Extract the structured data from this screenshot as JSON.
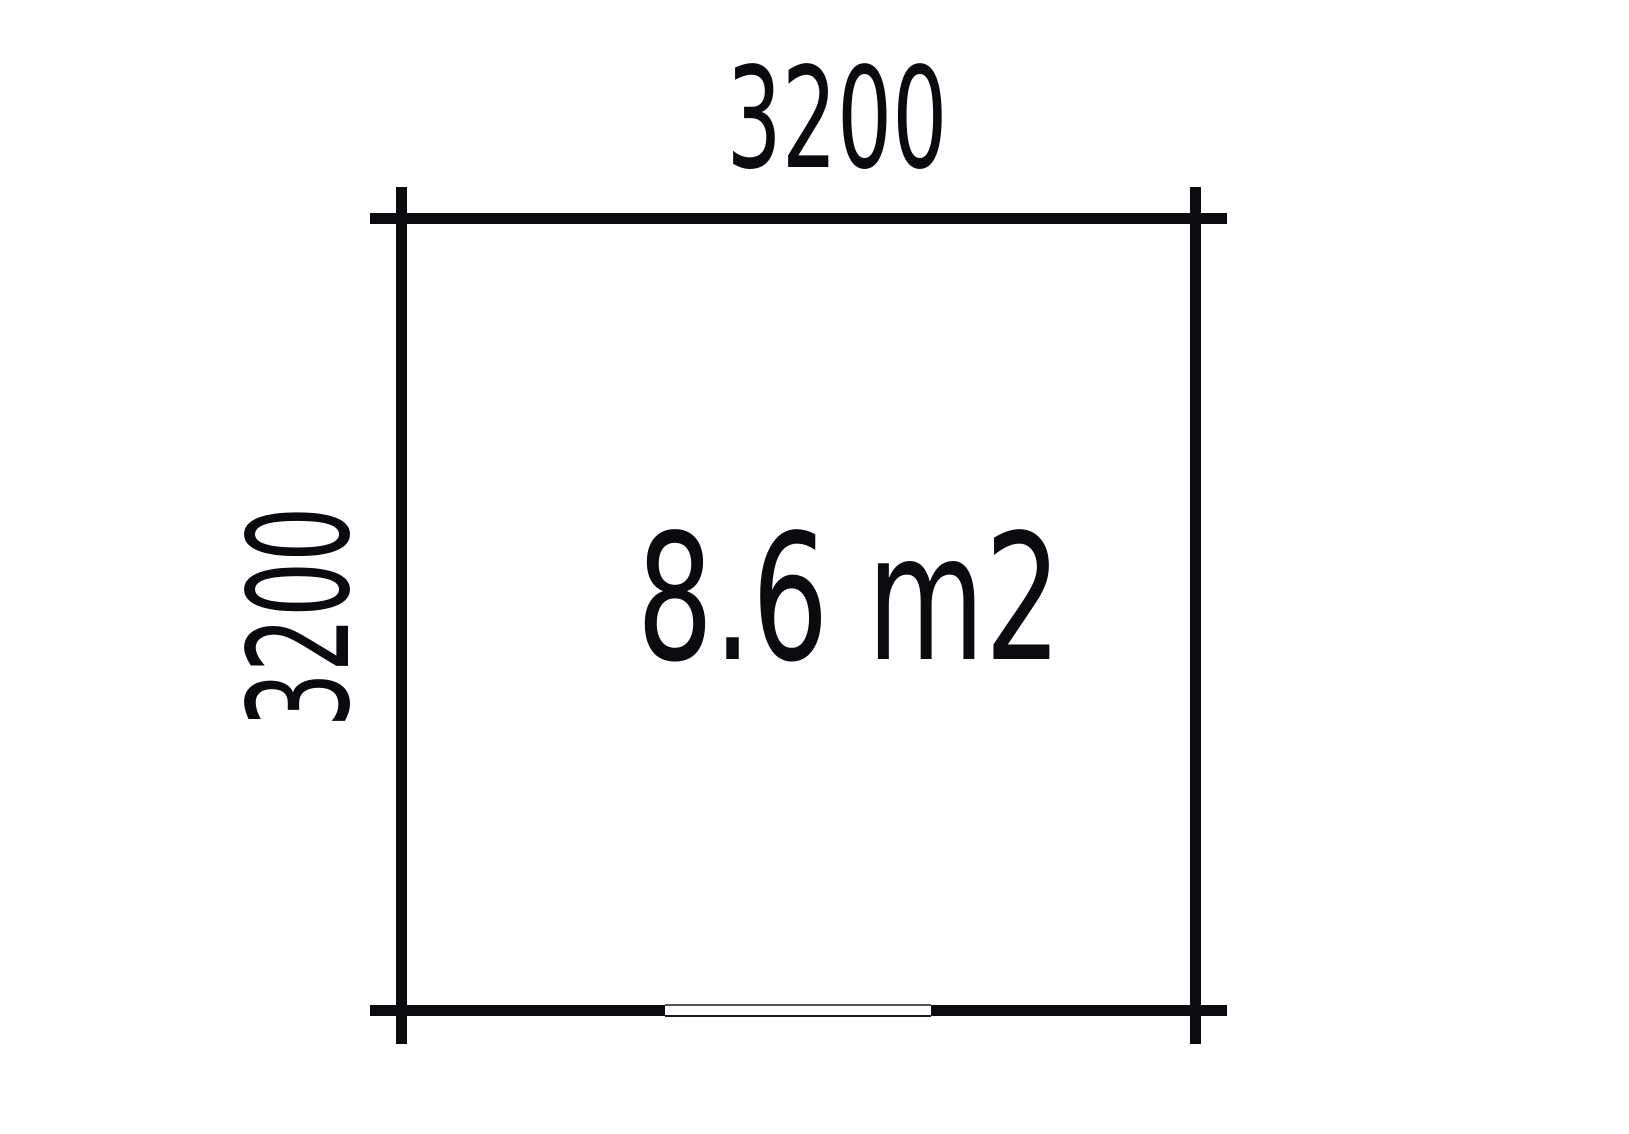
{
  "plan": {
    "width_label": "3200",
    "height_label": "3200",
    "area_label": "8.6 m2"
  },
  "colors": {
    "line": "#0b0b0f",
    "background": "#ffffff",
    "window_frame_top": "#50565b",
    "window_frame_bottom": "#1c1c20",
    "window_fill": "#ffffff"
  }
}
